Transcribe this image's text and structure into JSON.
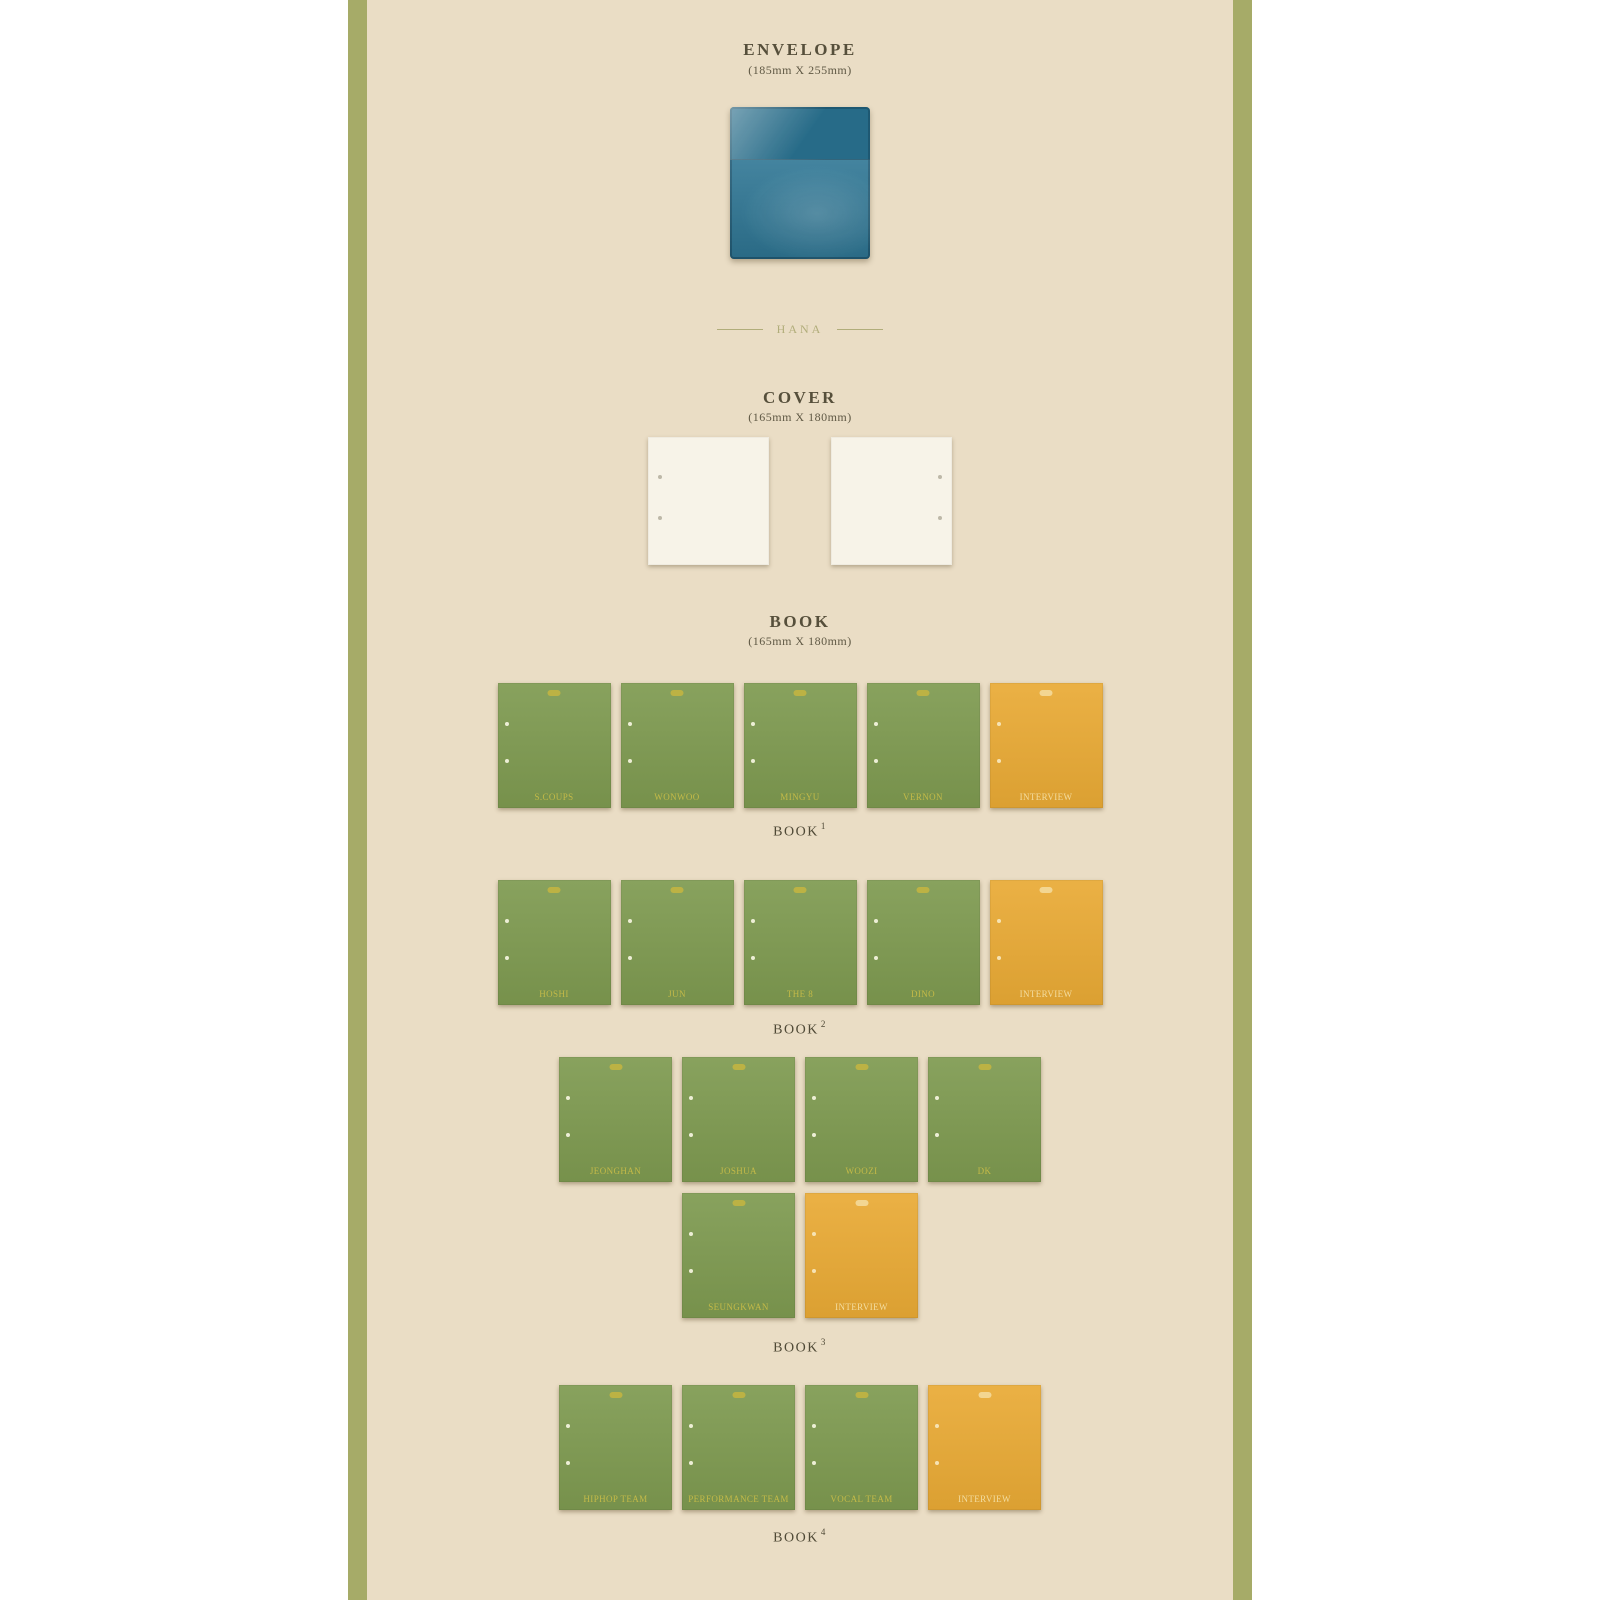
{
  "page": {
    "outer_background": "#ffffff",
    "panel_background": "#eaddc5",
    "stripe_color": "#a6ab68"
  },
  "envelope_section": {
    "title": "ENVELOPE",
    "dimensions": "(185mm X 255mm)",
    "envelope_color": "#2f7795"
  },
  "divider": {
    "label": "HANA"
  },
  "cover_section": {
    "title": "COVER",
    "dimensions": "(165mm X 180mm)",
    "cover_count": 2,
    "cover_color": "#f7f3e8"
  },
  "book_section": {
    "title": "BOOK",
    "dimensions": "(165mm X 180mm)",
    "member_book_color": "#7e9a50",
    "interview_book_color": "#e9aa35",
    "label_color_on_green": "#c4ba48",
    "label_color_on_yellow": "#f3dda1",
    "rows": [
      {
        "caption": "BOOK",
        "caption_sup": "1",
        "books": [
          {
            "label": "S.COUPS",
            "type": "member"
          },
          {
            "label": "WONWOO",
            "type": "member"
          },
          {
            "label": "MINGYU",
            "type": "member"
          },
          {
            "label": "VERNON",
            "type": "member"
          },
          {
            "label": "INTERVIEW",
            "type": "interview"
          }
        ]
      },
      {
        "caption": "BOOK",
        "caption_sup": "2",
        "books": [
          {
            "label": "HOSHI",
            "type": "member"
          },
          {
            "label": "JUN",
            "type": "member"
          },
          {
            "label": "THE 8",
            "type": "member"
          },
          {
            "label": "DINO",
            "type": "member"
          },
          {
            "label": "INTERVIEW",
            "type": "interview"
          }
        ]
      },
      {
        "caption": "BOOK",
        "caption_sup": "3",
        "books": [
          {
            "label": "JEONGHAN",
            "type": "member"
          },
          {
            "label": "JOSHUA",
            "type": "member"
          },
          {
            "label": "WOOZI",
            "type": "member"
          },
          {
            "label": "DK",
            "type": "member"
          },
          {
            "label": "SEUNGKWAN",
            "type": "member"
          },
          {
            "label": "INTERVIEW",
            "type": "interview"
          }
        ]
      },
      {
        "caption": "BOOK",
        "caption_sup": "4",
        "books": [
          {
            "label": "HIPHOP TEAM",
            "type": "member"
          },
          {
            "label": "PERFORMANCE TEAM",
            "type": "member"
          },
          {
            "label": "VOCAL TEAM",
            "type": "member"
          },
          {
            "label": "INTERVIEW",
            "type": "interview"
          }
        ]
      }
    ]
  }
}
